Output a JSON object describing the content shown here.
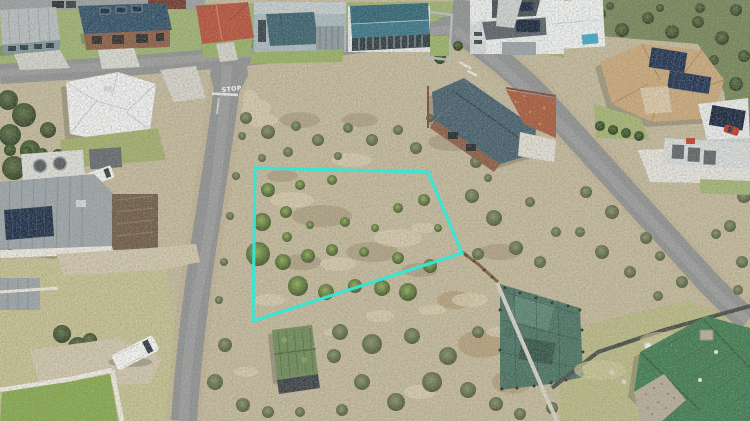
{
  "photo": {
    "kind": "aerial-drone-photo",
    "stop_marking": "STOP",
    "boundary": {
      "points": "255,168 428,172 462,253 253,321",
      "color": "#35e7d6"
    },
    "colors": {
      "sand": "#c2b89c",
      "asphalt": "#8f9193",
      "lawn": "#9db273",
      "dry_grass": "#c3bf92",
      "scrub": "#75865a",
      "net_garden": "#3e6b60",
      "roof_green": "#3f7c52",
      "roof_teal": "#2e6478",
      "roof_red": "#b5503c",
      "roof_tan": "#c9a87b",
      "roof_slate": "#455f6e"
    }
  }
}
